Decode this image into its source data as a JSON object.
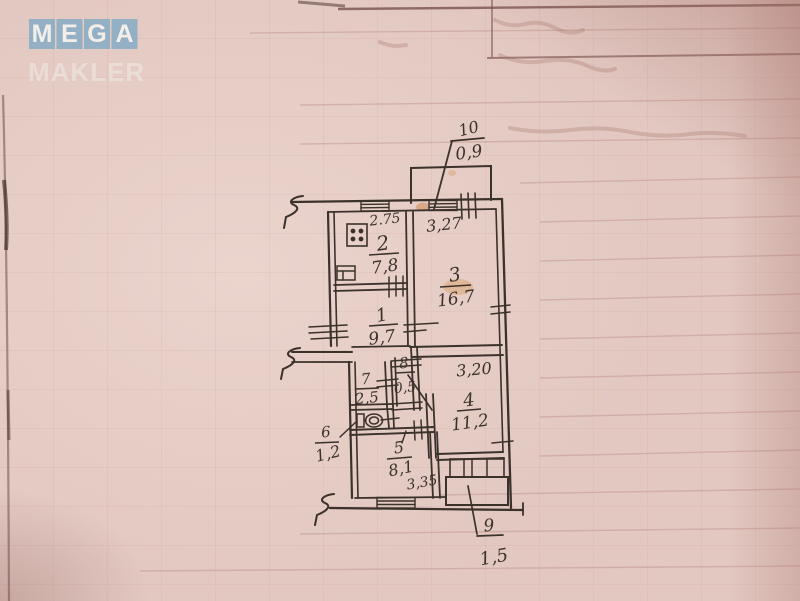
{
  "logo": {
    "tiles": [
      "M",
      "E",
      "G",
      "A"
    ],
    "subtitle": "MAKLER",
    "tile_color": "#8caec6",
    "text_color": "#f4eeea"
  },
  "plan": {
    "type": "apartment-floor-plan-hand-drawn",
    "ink_color": "#3a322b",
    "paper_color": "#e2c8c1",
    "rooms": [
      {
        "number": "10",
        "area": "0,9"
      },
      {
        "number": "2",
        "area": "7,8",
        "dim": "2.75"
      },
      {
        "number": "3",
        "area": "16,7",
        "dim": "3,27"
      },
      {
        "number": "1",
        "area": "9,7"
      },
      {
        "number": "7",
        "area": "2,5"
      },
      {
        "number": "8",
        "area": "0,5"
      },
      {
        "number": "4",
        "area": "11,2",
        "dim": "3,20"
      },
      {
        "number": "6",
        "area": "1,2"
      },
      {
        "number": "5",
        "area": "8,1",
        "dim": "3,35"
      },
      {
        "number": "9",
        "area": "1,5"
      }
    ],
    "icons": [
      "stove-icon",
      "sink-icon",
      "toilet-icon",
      "wall-break-icon",
      "window-hatch-icon"
    ]
  }
}
